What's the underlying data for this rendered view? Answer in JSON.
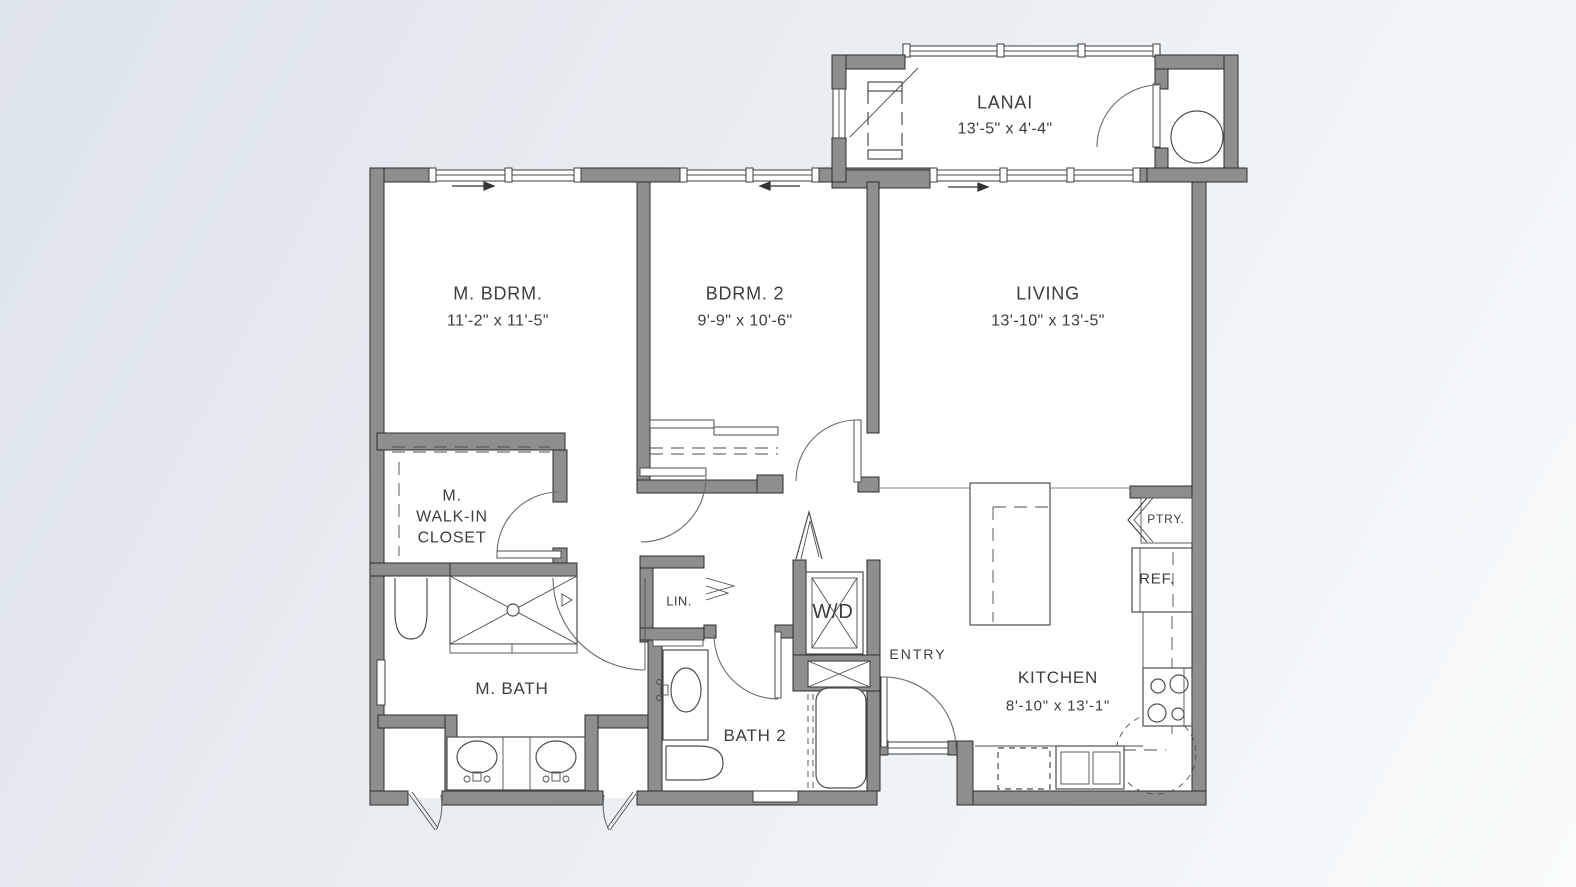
{
  "colors": {
    "background_start": "#dde4ea",
    "background_end": "#f9fbfc",
    "wall_fill": "#8e8e8e",
    "wall_outline": "#2c2c2c",
    "label_ink": "#3d3d3d"
  },
  "rooms": {
    "lanai": {
      "name": "LANAI",
      "dims": "13'-5\" x 4'-4\""
    },
    "master_bedroom": {
      "name": "M. BDRM.",
      "dims": "11'-2\" x 11'-5\""
    },
    "bedroom_2": {
      "name": "BDRM. 2",
      "dims": "9'-9\" x 10'-6\""
    },
    "living": {
      "name": "LIVING",
      "dims": "13'-10\" x 13'-5\""
    },
    "master_closet": {
      "line1": "M.",
      "line2": "WALK-IN",
      "line3": "CLOSET"
    },
    "linen": {
      "name": "LIN."
    },
    "washer_dryer": {
      "name": "W/D"
    },
    "master_bath": {
      "name": "M. BATH"
    },
    "bath_2": {
      "name": "BATH 2"
    },
    "entry": {
      "name": "ENTRY"
    },
    "kitchen": {
      "name": "KITCHEN",
      "dims": "8'-10\" x 13'-1\""
    },
    "pantry": {
      "name": "PTRY."
    },
    "refrigerator": {
      "name": "REF."
    }
  }
}
